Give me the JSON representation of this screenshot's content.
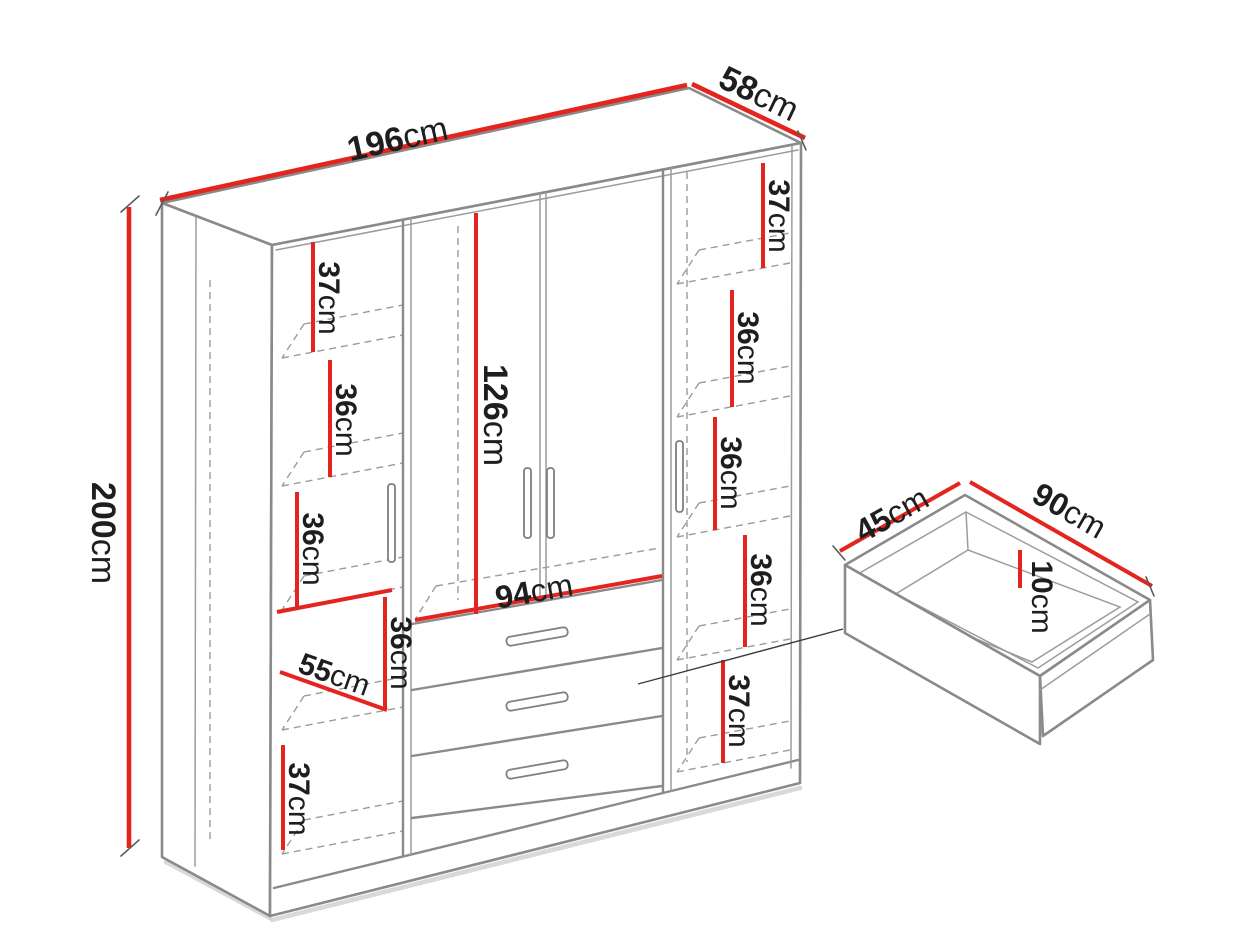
{
  "diagram": {
    "type": "furniture-dimension-diagram",
    "subject": "wardrobe with drawers",
    "colors": {
      "accent_red": "#e4251f",
      "line_gray": "#8a8a8a",
      "text": "#1e1e1e",
      "background": "#ffffff"
    }
  },
  "wardrobe": {
    "width": {
      "v": "196",
      "u": "cm"
    },
    "depth": {
      "v": "58",
      "u": "cm"
    },
    "height": {
      "v": "200",
      "u": "cm"
    },
    "left_column": {
      "c1": {
        "v": "37",
        "u": "cm"
      },
      "c2": {
        "v": "36",
        "u": "cm"
      },
      "c3": {
        "v": "36",
        "u": "cm"
      },
      "c4": {
        "v": "36",
        "u": "cm"
      },
      "c5": {
        "v": "37",
        "u": "cm"
      },
      "shelf_depth": {
        "v": "55",
        "u": "cm"
      }
    },
    "center_column": {
      "door_height": {
        "v": "126",
        "u": "cm"
      },
      "drawer_width": {
        "v": "94",
        "u": "cm"
      }
    },
    "right_column": {
      "c1": {
        "v": "37",
        "u": "cm"
      },
      "c2": {
        "v": "36",
        "u": "cm"
      },
      "c3": {
        "v": "36",
        "u": "cm"
      },
      "c4": {
        "v": "36",
        "u": "cm"
      },
      "c5": {
        "v": "37",
        "u": "cm"
      }
    }
  },
  "drawer_detail": {
    "depth": {
      "v": "45",
      "u": "cm"
    },
    "width": {
      "v": "90",
      "u": "cm"
    },
    "height": {
      "v": "10",
      "u": "cm"
    }
  }
}
